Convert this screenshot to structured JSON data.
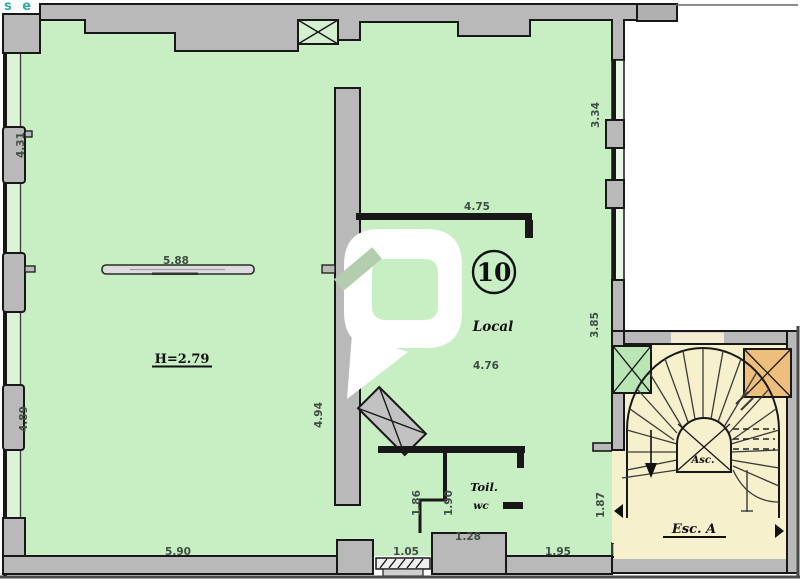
{
  "logo": {
    "fragment": "s e",
    "color": "#2faaa2"
  },
  "unit": {
    "number": "10",
    "name": "Local",
    "ceiling_height": "H=2.79"
  },
  "rooms": {
    "toilet_line1": "Toil.",
    "toilet_line2": "wc",
    "elevator_label": "Asc.",
    "staircase_label": "Esc. A"
  },
  "dimensions": {
    "left_wall_upper": "4.31",
    "left_wall_lower": "4.89",
    "radiator_length": "5.88",
    "room_width_bottom": "5.90",
    "inner_wall_length": "4.75",
    "local_width": "4.76",
    "right_wall_upper": "3.34",
    "right_wall_mid": "3.85",
    "right_wall_lower": "1.87",
    "partition_height": "4.94",
    "toilet_depth_left": "1.86",
    "toilet_depth_right": "1.90",
    "toilet_width": "1.28",
    "entrance_width": "1.05",
    "bottom_right_width": "1.95"
  },
  "colors": {
    "floor": "#c8eec3",
    "wall": "#b9b9b9",
    "outline": "#181818",
    "stair_floor": "#f6f0cc",
    "shaft_orange": "#edbe7c",
    "shaft_green": "#b9e6b4",
    "dimension_text": "#3f4e43",
    "label_text": "#101010",
    "logo_teal": "#2faaa2"
  }
}
